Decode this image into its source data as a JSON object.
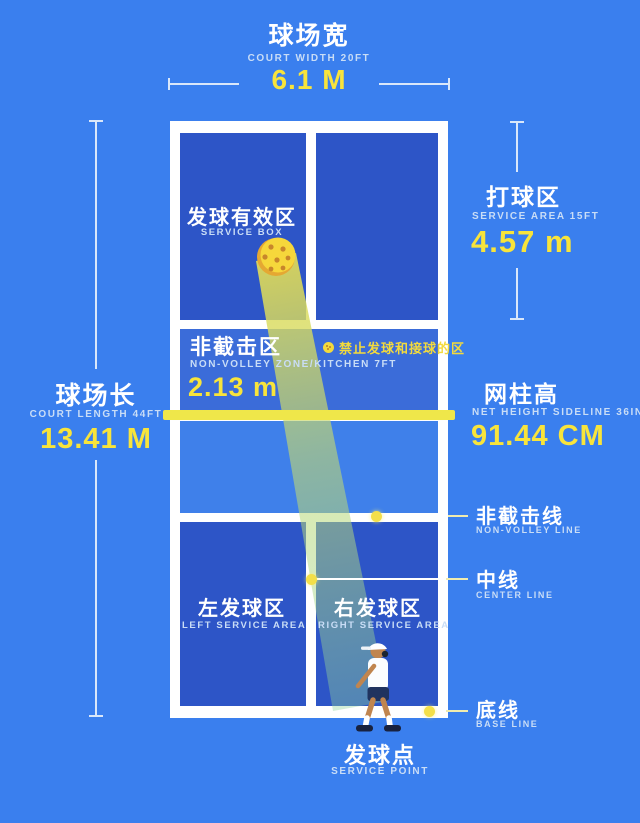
{
  "header": {
    "title_zh": "球场宽",
    "subtitle_en": "COURT WIDTH 20FT",
    "value": "6.1 M"
  },
  "left_measure": {
    "title_zh": "球场长",
    "subtitle_en": "COURT LENGTH 44FT",
    "value": "13.41 M"
  },
  "right": {
    "service_area": {
      "title_zh": "打球区",
      "subtitle_en": "SERVICE AREA 15FT",
      "value": "4.57 m"
    },
    "net_height": {
      "title_zh": "网柱高",
      "subtitle_en": "NET HEIGHT SIDELINE 36IN",
      "value": "91.44 CM"
    }
  },
  "court": {
    "service_box": {
      "zh": "发球有效区",
      "en": "SERVICE BOX"
    },
    "non_volley_zone": {
      "zh": "非截击区",
      "en": "NON-VOLLEY ZONE/KITCHEN 7FT",
      "value": "2.13 m",
      "warning": "禁止发球和接球的区"
    },
    "left_service": {
      "zh": "左发球区",
      "en": "LEFT SERVICE AREA"
    },
    "right_service": {
      "zh": "右发球区",
      "en": "RIGHT SERVICE AREA"
    }
  },
  "lines": {
    "non_volley": {
      "zh": "非截击线",
      "en": "NON-VOLLEY LINE"
    },
    "center": {
      "zh": "中线",
      "en": "CENTER LINE"
    },
    "base": {
      "zh": "底线",
      "en": "BASE LINE"
    }
  },
  "footer": {
    "zh": "发球点",
    "en": "SERVICE POINT"
  },
  "colors": {
    "background": "#3a7fee",
    "panel_dark": "#2d55c7",
    "panel_medium": "#3b6cd9",
    "panel_light": "#3f80ea",
    "court_line": "#ffffff",
    "accent_yellow": "#f8e43b",
    "net_yellow": "#efe74a",
    "warning_yellow": "#f3da3d",
    "sublabel_blue": "#c9ddf6",
    "ball_yellow": "#f6d73b",
    "beam_green": "#9fd49a"
  }
}
